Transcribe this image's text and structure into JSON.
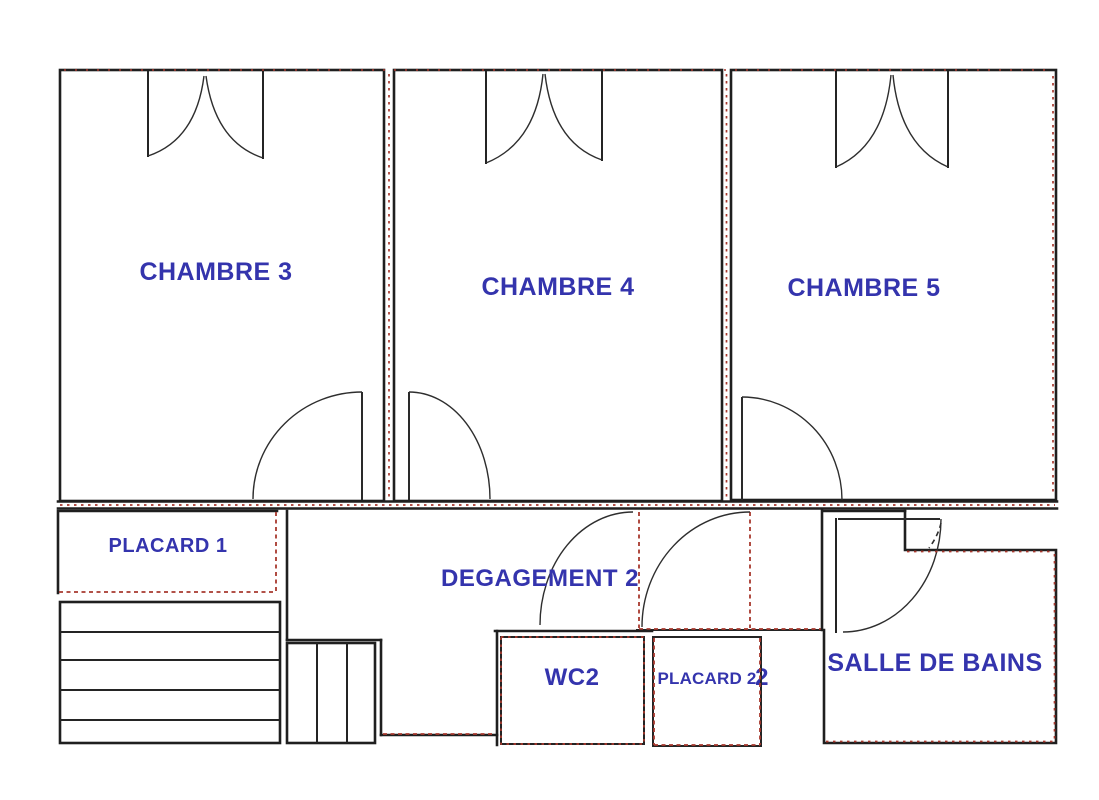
{
  "plan": {
    "type": "floor-plan",
    "floor_description": "upper floor with three bedrooms, hallway, closets, WC and bathroom",
    "colors": {
      "background": "#ffffff",
      "walls": "#1f1f1f",
      "labels": "#3434ad",
      "hatching": "#a8392e"
    },
    "rooms": {
      "chambre3": {
        "label": "CHAMBRE 3"
      },
      "chambre4": {
        "label": "CHAMBRE 4"
      },
      "chambre5": {
        "label": "CHAMBRE 5"
      },
      "placard1": {
        "label": "PLACARD 1"
      },
      "degagement2": {
        "label": "DEGAGEMENT 2"
      },
      "wc2": {
        "label": "WC2"
      },
      "placard2": {
        "label": "PLACARD 2"
      },
      "hidden2": {
        "label": "2"
      },
      "salledebains": {
        "label": "SALLE DE BAINS"
      }
    }
  }
}
